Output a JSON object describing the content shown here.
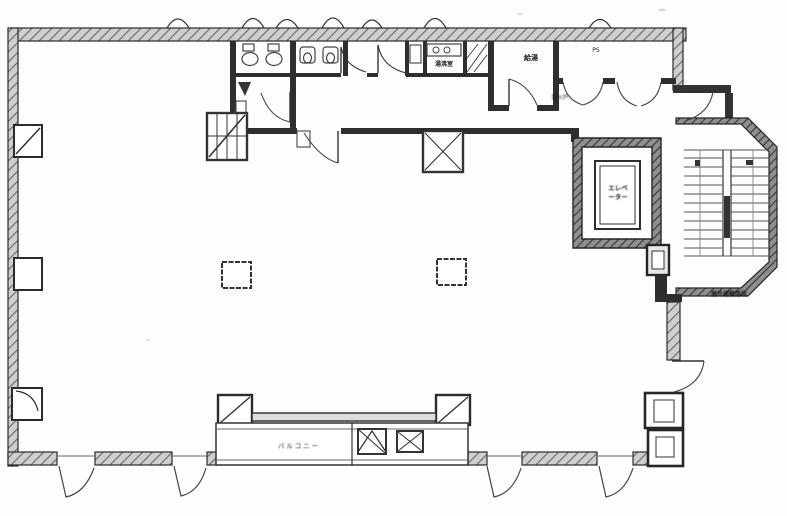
{
  "plan": {
    "title": "building-floor-plan-scan",
    "labels": {
      "elevator_line1": "エレベ",
      "elevator_line2": "ーター",
      "exterior_stair": "屋外避難階段",
      "balcony": "バルコニー",
      "kitchenette": "湯沸室",
      "hot_water": "給湯",
      "pipe_space": "PS",
      "fire_door": "防火戸"
    }
  }
}
